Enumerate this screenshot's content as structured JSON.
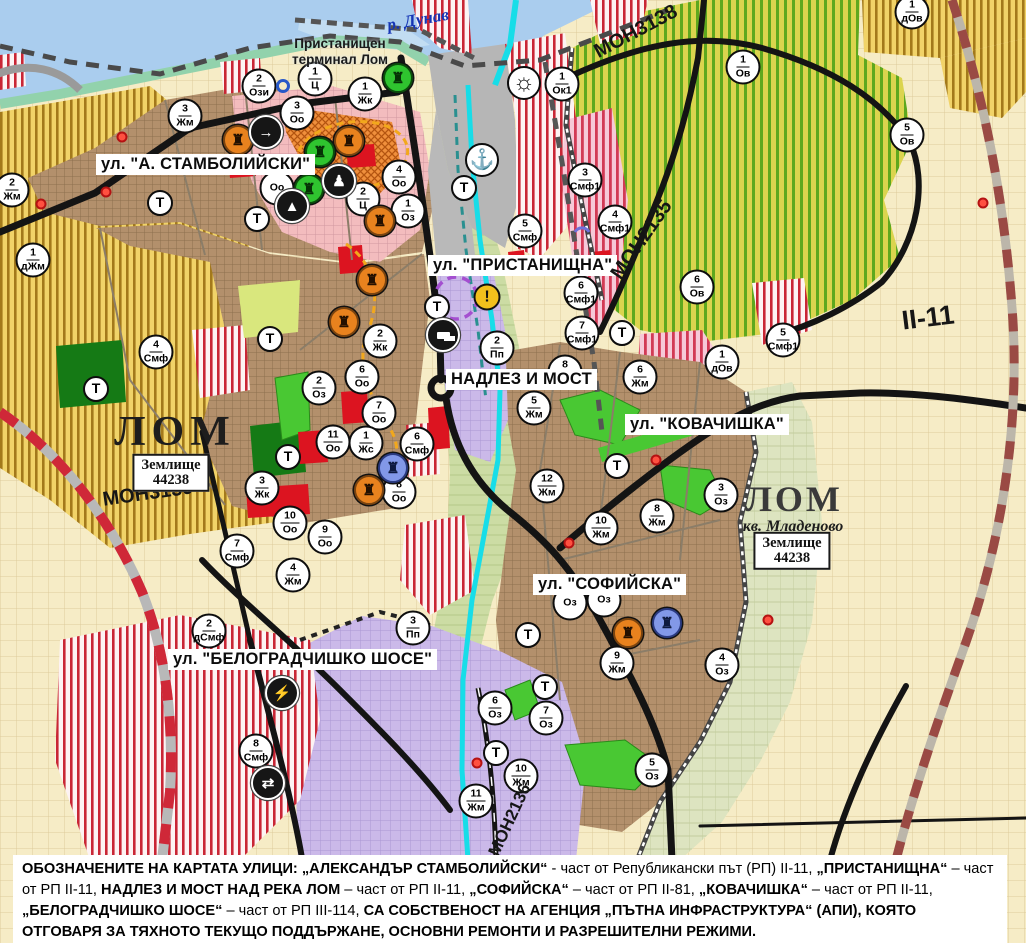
{
  "map": {
    "t_label": "Т",
    "river_label": "р. Дунав",
    "terminal_label_line1": "Пристанищен",
    "terminal_label_line2": "терминал Лом",
    "street_labels": [
      {
        "id": "stamboliyski",
        "text": "ул. \"А. СТАМБОЛИЙСКИ\"",
        "x": 96,
        "y": 154
      },
      {
        "id": "pristanishtna",
        "text": "ул. \"ПРИСТАНИЩНА\"",
        "x": 428,
        "y": 255
      },
      {
        "id": "nadlez-i-most",
        "text": "НАДЛЕЗ И МОСТ",
        "x": 446,
        "y": 369
      },
      {
        "id": "kovachishka",
        "text": "ул. \"КОВАЧИШКА\"",
        "x": 625,
        "y": 414
      },
      {
        "id": "sofiyska",
        "text": "ул. \"СОФИЙСКА\"",
        "x": 533,
        "y": 574
      },
      {
        "id": "belogradchishko-shose",
        "text": "ул. \"БЕЛОГРАДЧИШКО ШОСЕ\"",
        "x": 168,
        "y": 649
      }
    ],
    "road_labels": [
      {
        "id": "mon3139",
        "text": "МОН3139",
        "x": 148,
        "y": 494,
        "rot": -8,
        "size": 20
      },
      {
        "id": "mon3138",
        "text": "МОН3138",
        "x": 636,
        "y": 32,
        "rot": -28,
        "size": 20
      },
      {
        "id": "mon2135",
        "text": "МОН2135",
        "x": 642,
        "y": 240,
        "rot": -55,
        "size": 20
      },
      {
        "id": "mon2136",
        "text": "МОН2136",
        "x": 510,
        "y": 820,
        "rot": -65,
        "size": 17
      },
      {
        "id": "ii-11",
        "text": "II-11",
        "x": 928,
        "y": 318,
        "rot": -7,
        "size": 27
      }
    ],
    "area_labels": [
      {
        "id": "lom-west",
        "text": "ЛОМ",
        "x": 175,
        "y": 432,
        "cls": "lom"
      },
      {
        "id": "lom-mladenovo",
        "text": "ЛОМ",
        "x": 794,
        "y": 499,
        "cls": "lom right"
      },
      {
        "id": "kv-mladenovo",
        "text": "кв. Младеново",
        "x": 793,
        "y": 527,
        "cls": "kvartal"
      }
    ],
    "info_boxes": [
      {
        "id": "zemlishte-west",
        "line1": "Землище",
        "line2": "44238",
        "x": 171,
        "y": 473
      },
      {
        "id": "zemlishte-east",
        "line1": "Землище",
        "line2": "44238",
        "x": 792,
        "y": 551
      }
    ],
    "zone_markers": [
      {
        "x": 12,
        "y": 190,
        "n": "2",
        "c": "Жм"
      },
      {
        "x": 33,
        "y": 260,
        "n": "1",
        "c": "дЖм"
      },
      {
        "x": 185,
        "y": 116,
        "n": "3",
        "c": "Жм"
      },
      {
        "x": 259,
        "y": 86,
        "n": "2",
        "c": "Ози"
      },
      {
        "x": 315,
        "y": 79,
        "n": "1",
        "c": "Ц"
      },
      {
        "x": 365,
        "y": 94,
        "n": "1",
        "c": "Жк"
      },
      {
        "x": 297,
        "y": 113,
        "n": "3",
        "c": "Оо"
      },
      {
        "x": 277,
        "y": 188,
        "n": "",
        "c": "Оо"
      },
      {
        "x": 399,
        "y": 177,
        "n": "4",
        "c": "Оо"
      },
      {
        "x": 363,
        "y": 199,
        "n": "2",
        "c": "Ц"
      },
      {
        "x": 408,
        "y": 211,
        "n": "1",
        "c": "Оз"
      },
      {
        "x": 562,
        "y": 84,
        "n": "1",
        "c": "Ок1"
      },
      {
        "x": 585,
        "y": 180,
        "n": "3",
        "c": "Смф1"
      },
      {
        "x": 615,
        "y": 222,
        "n": "4",
        "c": "Смф1"
      },
      {
        "x": 525,
        "y": 231,
        "n": "5",
        "c": "Смф"
      },
      {
        "x": 581,
        "y": 293,
        "n": "6",
        "c": "Смф1"
      },
      {
        "x": 582,
        "y": 333,
        "n": "7",
        "c": "Смф1"
      },
      {
        "x": 497,
        "y": 348,
        "n": "2",
        "c": "Пп"
      },
      {
        "x": 380,
        "y": 341,
        "n": "2",
        "c": "Жк"
      },
      {
        "x": 362,
        "y": 377,
        "n": "6",
        "c": "Оо"
      },
      {
        "x": 319,
        "y": 388,
        "n": "2",
        "c": "Оз"
      },
      {
        "x": 379,
        "y": 413,
        "n": "7",
        "c": "Оо"
      },
      {
        "x": 333,
        "y": 442,
        "n": "11",
        "c": "Оо"
      },
      {
        "x": 366,
        "y": 443,
        "n": "1",
        "c": "Жс"
      },
      {
        "x": 417,
        "y": 444,
        "n": "6",
        "c": "Смф"
      },
      {
        "x": 156,
        "y": 352,
        "n": "4",
        "c": "Смф"
      },
      {
        "x": 262,
        "y": 488,
        "n": "3",
        "c": "Жк"
      },
      {
        "x": 399,
        "y": 492,
        "n": "8",
        "c": "Оо"
      },
      {
        "x": 290,
        "y": 523,
        "n": "10",
        "c": "Оо"
      },
      {
        "x": 325,
        "y": 537,
        "n": "9",
        "c": "Оо"
      },
      {
        "x": 237,
        "y": 551,
        "n": "7",
        "c": "Смф"
      },
      {
        "x": 293,
        "y": 575,
        "n": "4",
        "c": "Жм"
      },
      {
        "x": 209,
        "y": 631,
        "n": "2",
        "c": "дСмф"
      },
      {
        "x": 413,
        "y": 628,
        "n": "3",
        "c": "Пп"
      },
      {
        "x": 256,
        "y": 751,
        "n": "8",
        "c": "Смф"
      },
      {
        "x": 534,
        "y": 408,
        "n": "5",
        "c": "Жм"
      },
      {
        "x": 565,
        "y": 372,
        "n": "8",
        "c": "Жм"
      },
      {
        "x": 640,
        "y": 377,
        "n": "6",
        "c": "Жм"
      },
      {
        "x": 547,
        "y": 486,
        "n": "12",
        "c": "Жм"
      },
      {
        "x": 601,
        "y": 528,
        "n": "10",
        "c": "Жм"
      },
      {
        "x": 657,
        "y": 516,
        "n": "8",
        "c": "Жм"
      },
      {
        "x": 721,
        "y": 495,
        "n": "3",
        "c": "Оз"
      },
      {
        "x": 617,
        "y": 663,
        "n": "9",
        "c": "Жм"
      },
      {
        "x": 570,
        "y": 603,
        "n": "",
        "c": "Оз"
      },
      {
        "x": 604,
        "y": 600,
        "n": "",
        "c": "Оз"
      },
      {
        "x": 722,
        "y": 665,
        "n": "4",
        "c": "Оз"
      },
      {
        "x": 495,
        "y": 708,
        "n": "6",
        "c": "Оз"
      },
      {
        "x": 546,
        "y": 718,
        "n": "7",
        "c": "Оз"
      },
      {
        "x": 521,
        "y": 776,
        "n": "10",
        "c": "Жм"
      },
      {
        "x": 476,
        "y": 801,
        "n": "11",
        "c": "Жм"
      },
      {
        "x": 652,
        "y": 770,
        "n": "5",
        "c": "Оз"
      },
      {
        "x": 743,
        "y": 67,
        "n": "1",
        "c": "Ов"
      },
      {
        "x": 907,
        "y": 135,
        "n": "5",
        "c": "Ов"
      },
      {
        "x": 697,
        "y": 287,
        "n": "6",
        "c": "Ов"
      },
      {
        "x": 722,
        "y": 362,
        "n": "1",
        "c": "дОв"
      },
      {
        "x": 783,
        "y": 340,
        "n": "5",
        "c": "Смф1"
      },
      {
        "x": 912,
        "y": 12,
        "n": "1",
        "c": "дОв"
      }
    ],
    "t_markers": [
      {
        "x": 160,
        "y": 203
      },
      {
        "x": 257,
        "y": 219
      },
      {
        "x": 464,
        "y": 188
      },
      {
        "x": 437,
        "y": 307
      },
      {
        "x": 270,
        "y": 339
      },
      {
        "x": 288,
        "y": 457
      },
      {
        "x": 96,
        "y": 389
      },
      {
        "x": 622,
        "y": 333
      },
      {
        "x": 617,
        "y": 466
      },
      {
        "x": 528,
        "y": 635
      },
      {
        "x": 545,
        "y": 687
      },
      {
        "x": 496,
        "y": 753
      }
    ],
    "icon_glyphs": {
      "monument": "♜",
      "arrow": "→",
      "person": "♟",
      "cave": "▲",
      "truck": "",
      "lightning": "⚡",
      "arrows": "⇄",
      "anchor": "⚓",
      "sun": "☼",
      "warning": "!"
    },
    "icon_markers": [
      {
        "x": 238,
        "y": 140,
        "kind": "monument-orange"
      },
      {
        "x": 349,
        "y": 141,
        "kind": "monument-orange"
      },
      {
        "x": 380,
        "y": 221,
        "kind": "monument-orange"
      },
      {
        "x": 372,
        "y": 280,
        "kind": "monument-orange"
      },
      {
        "x": 344,
        "y": 322,
        "kind": "monument-orange"
      },
      {
        "x": 369,
        "y": 490,
        "kind": "monument-orange"
      },
      {
        "x": 628,
        "y": 633,
        "kind": "monument-orange"
      },
      {
        "x": 398,
        "y": 78,
        "kind": "monument-green"
      },
      {
        "x": 320,
        "y": 152,
        "kind": "monument-green"
      },
      {
        "x": 309,
        "y": 189,
        "kind": "monument-green"
      },
      {
        "x": 393,
        "y": 468,
        "kind": "monument-blue"
      },
      {
        "x": 667,
        "y": 623,
        "kind": "monument-blue"
      },
      {
        "x": 266,
        "y": 132,
        "kind": "arrow-black"
      },
      {
        "x": 339,
        "y": 181,
        "kind": "person-black"
      },
      {
        "x": 292,
        "y": 206,
        "kind": "cave-black"
      },
      {
        "x": 443,
        "y": 335,
        "kind": "truck-black"
      },
      {
        "x": 282,
        "y": 693,
        "kind": "lightning-black"
      },
      {
        "x": 268,
        "y": 783,
        "kind": "arrows-black"
      },
      {
        "x": 482,
        "y": 160,
        "kind": "anchor-white"
      },
      {
        "x": 524,
        "y": 83,
        "kind": "sun-white"
      },
      {
        "x": 487,
        "y": 297,
        "kind": "warning-yellow"
      }
    ],
    "red_dots": [
      {
        "x": 122,
        "y": 137
      },
      {
        "x": 106,
        "y": 192
      },
      {
        "x": 41,
        "y": 204
      },
      {
        "x": 569,
        "y": 543
      },
      {
        "x": 656,
        "y": 460
      },
      {
        "x": 983,
        "y": 203
      },
      {
        "x": 768,
        "y": 620
      },
      {
        "x": 477,
        "y": 763
      }
    ],
    "blue_ring": {
      "x": 283,
      "y": 86
    },
    "colors": {
      "water": "#aacdee",
      "canal": "#17dde8",
      "urban": "#b3906c",
      "villa_stripe": "#a3791b",
      "vineyard_stripe": "#5ea81e",
      "mixed_red": "#c92635",
      "lavender": "#cbb9e9",
      "park_green": "#157a15",
      "oz_green": "#49c833",
      "road_black": "#141414",
      "ring_red": "#cf2838"
    }
  },
  "footer": {
    "segments": [
      {
        "t": "ОБОЗНАЧЕНИТЕ НА КАРТАТА УЛИЦИ: „АЛЕКСАНДЪР СТАМБОЛИЙСКИ“",
        "b": true
      },
      {
        "t": " - част от Републикански път (РП) II-11, ",
        "b": false
      },
      {
        "t": "„ПРИСТАНИЩНА“",
        "b": true
      },
      {
        "t": " – част от РП II-11, ",
        "b": false
      },
      {
        "t": "НАДЛЕЗ И МОСТ НАД РЕКА ЛОМ",
        "b": true
      },
      {
        "t": " – част от РП II-11, ",
        "b": false
      },
      {
        "t": "„СОФИЙСКА“",
        "b": true
      },
      {
        "t": " – част от РП II-81, ",
        "b": false
      },
      {
        "t": "„КОВАЧИШКА“",
        "b": true
      },
      {
        "t": " – част от РП II-11, ",
        "b": false
      },
      {
        "t": "„БЕЛОГРАДЧИШКО ШОСЕ“",
        "b": true
      },
      {
        "t": " – част от РП III-114, ",
        "b": false
      },
      {
        "t": "СА СОБСТВЕНОСТ НА АГЕНЦИЯ „ПЪТНА ИНФРАСТРУКТУРА“ (АПИ), КОЯТО ОТГОВАРЯ ЗА ТЯХНОТО ТЕКУЩО ПОДДЪРЖАНЕ, ОСНОВНИ РЕМОНТИ И РАЗРЕШИТЕЛНИ РЕЖИМИ.",
        "b": true
      }
    ]
  }
}
